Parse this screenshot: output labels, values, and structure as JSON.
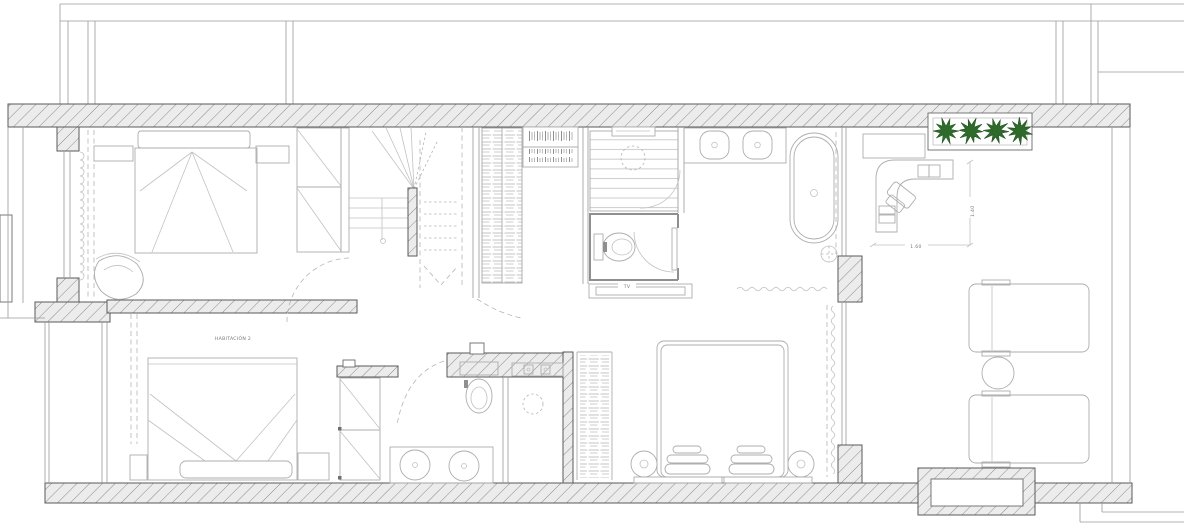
{
  "meta": {
    "type": "architectural-floor-plan",
    "floor": "upper level"
  },
  "labels": {
    "room2": "HABITACIÓN 2",
    "tv": "TV"
  },
  "dimensions": {
    "desk_width": "1.60",
    "desk_depth": "1.40"
  },
  "colors": {
    "background": "#ffffff",
    "plant_green": "#2e6b2b",
    "plant_green_dark": "#1c4f1c",
    "wall_line": "#5a5a5a",
    "furniture_line": "#adadad",
    "text": "#777777"
  },
  "plan": {
    "rooms": [
      {
        "name": "bedroom-1",
        "furniture": [
          "double-bed",
          "headboard",
          "nightstand",
          "dresser",
          "armchair",
          "wardrobe",
          "window-curtain"
        ]
      },
      {
        "name": "hall-staircase",
        "furniture": [
          "winder-staircase",
          "shelving-unit",
          "bookshelf",
          "door-swing"
        ]
      },
      {
        "name": "shower-room",
        "furniture": [
          "slatted-floor",
          "rain-shower-head",
          "glass-door"
        ]
      },
      {
        "name": "wc",
        "furniture": [
          "wall-hung-toilet",
          "door"
        ]
      },
      {
        "name": "bathroom-main",
        "furniture": [
          "vanity-two-sinks",
          "freestanding-bathtub",
          "floor-drain",
          "shower-curtain"
        ]
      },
      {
        "name": "master-bedroom",
        "label_ref": "tv",
        "furniture": [
          "double-bed",
          "pillows",
          "round-nightstand",
          "round-nightstand",
          "foot-bench",
          "wardrobe",
          "tv-console",
          "curtain"
        ]
      },
      {
        "name": "bedroom-2",
        "label_ref": "room2",
        "furniture": [
          "double-bed",
          "headboard",
          "nightstand",
          "nightstand",
          "tall-cabinet",
          "window-curtain"
        ]
      },
      {
        "name": "bathroom-2",
        "furniture": [
          "toilet",
          "shower-floor-drain",
          "vanity-two-round-sinks",
          "shower-niche",
          "door-swing"
        ]
      },
      {
        "name": "terrace",
        "dimension_refs": [
          "desk_width",
          "desk_depth"
        ],
        "furniture": [
          "planter-with-plants",
          "wall-bench",
          "l-shaped-desk",
          "office-chair",
          "sun-lounger",
          "sun-lounger",
          "round-side-table"
        ]
      }
    ],
    "planter_plant_count": 4
  }
}
